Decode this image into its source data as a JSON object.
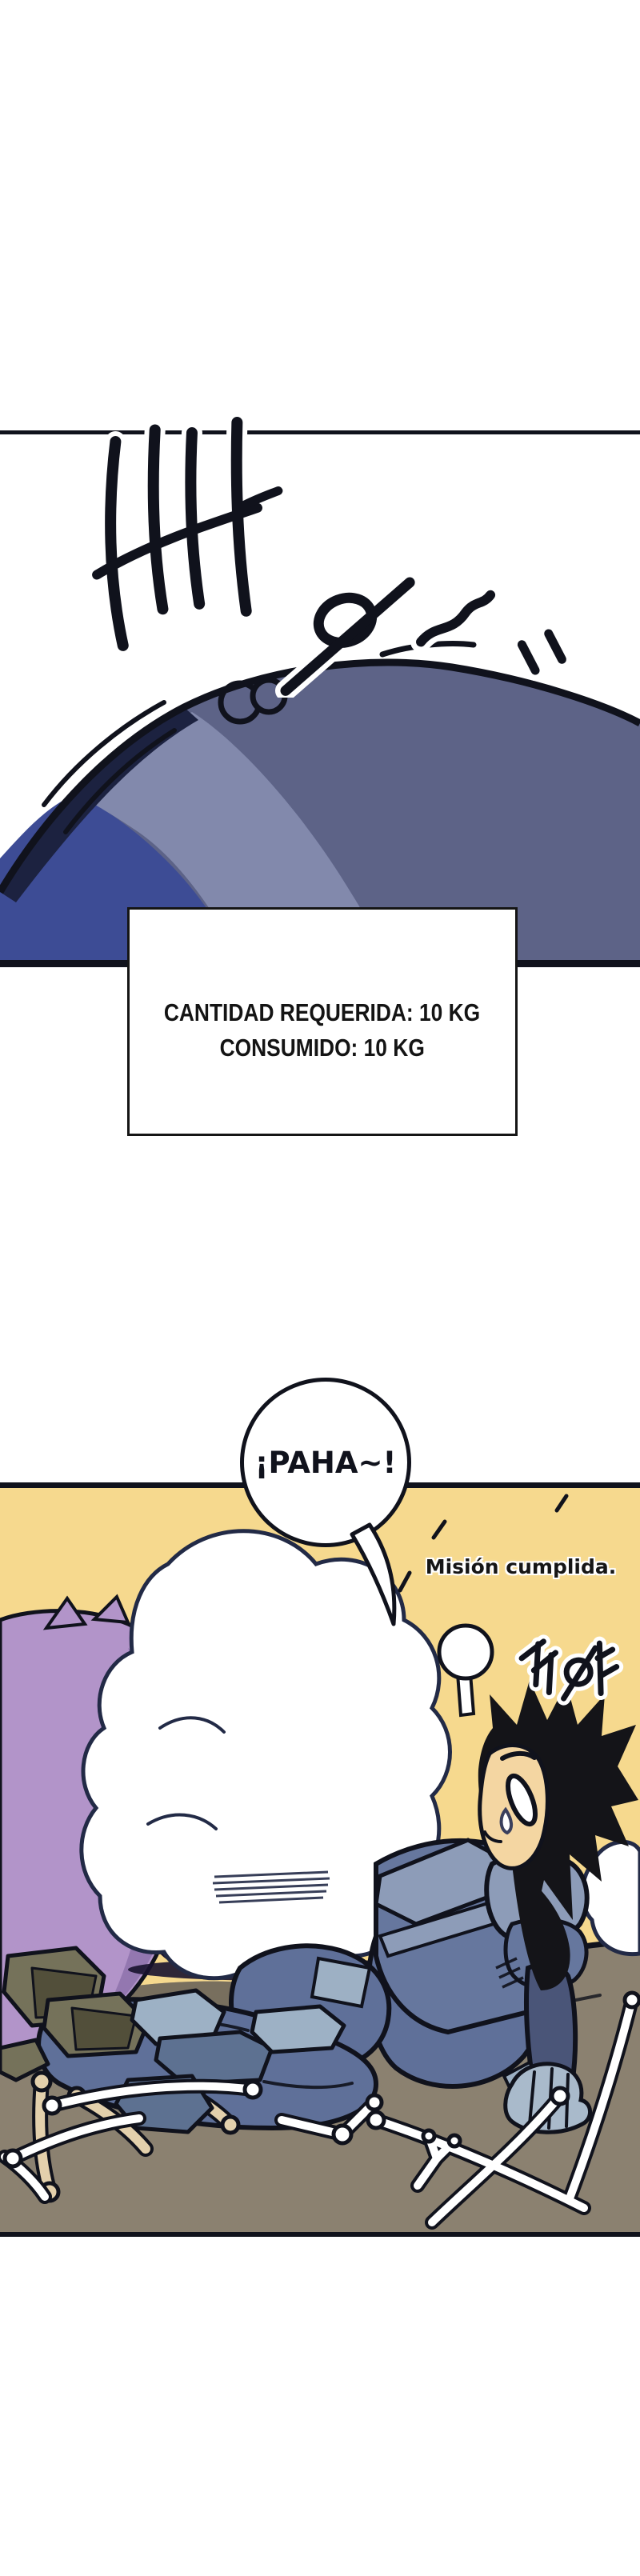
{
  "page": {
    "kind": "webtoon-comic-strip",
    "background": "#ffffff"
  },
  "sfx_top": {
    "text": "빠방~‥",
    "translit": "bba-bang~ (boom)"
  },
  "status_box": {
    "line1": "CANTIDAD REQUERIDA: 10 KG",
    "line2": "CONSUMIDO: 10 KG"
  },
  "speech_bubble": {
    "text": "¡PAHA~!"
  },
  "caption": {
    "text": "Misión cumplida."
  },
  "sfx_burp": {
    "text": "꺼억",
    "translit": "kkeok (burp)"
  },
  "colors": {
    "ink": "#10121c",
    "paper": "#ffffff",
    "dome_main": "#5d6387",
    "dome_light": "#8289ac",
    "dome_indigo": "#3d4c95",
    "dome_shadow": "#1c2240",
    "panel_yellow": "#f6d98e",
    "purple_light": "#b294c9",
    "purple_dark": "#8d72ab",
    "void_dark": "#18122d",
    "scratch_red": "#a8503e",
    "skin": "#f4d6a2",
    "hair": "#141418",
    "armor_light": "#8d9cb8",
    "armor_mid": "#66779e",
    "armor_dark": "#4a5578",
    "pants": "#5f7099",
    "patch": "#9db0c4",
    "glove": "#a9bacb",
    "ground": "#8b8170",
    "ground_dark": "#6e6555",
    "rock_olive": "#75725a",
    "rock_olive_dark": "#524f3a",
    "rock_slate": "#9db1c5",
    "rock_slate_dark": "#5d7191",
    "bone_white": "#ffffff",
    "bone_tan": "#e3d0ac"
  }
}
